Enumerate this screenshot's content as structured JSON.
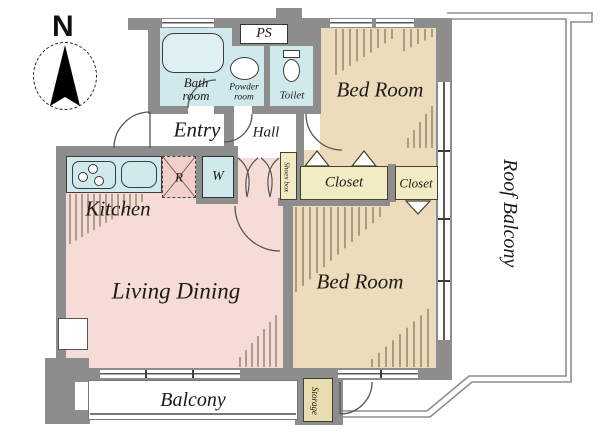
{
  "plan": {
    "north_label": "N",
    "rooms": {
      "entry": "Entry",
      "hall": "Hall",
      "bath": "Bath room",
      "powder": "Powder room",
      "toilet": "Toilet",
      "ps": "PS",
      "bedroom_top": "Bed Room",
      "bedroom_bottom": "Bed Room",
      "kitchen": "Kitchen",
      "living_dining": "Living Dining",
      "closet_left": "Closet",
      "closet_right": "Closet",
      "shoes_box": "Shoes box",
      "washing_machine": "W",
      "refrigerator": "R",
      "balcony": "Balcony",
      "roof_balcony": "Roof Balcony",
      "storage": "Storage"
    },
    "icons": {
      "north_arrow": "compass-needle",
      "bathtub": "bathtub-shape",
      "wash_basin": "oval-basin",
      "toilet_bowl": "toilet-shape",
      "stove": "three-burner-stove",
      "kitchen_sink": "rounded-sink"
    },
    "colors": {
      "wall": "#8d8d8d",
      "wet_rooms": "#cfe9ed",
      "bedrooms": "#ecdcbc",
      "living": "#f6dcd6",
      "closet": "#f1ecc3",
      "storage": "#e9dcae",
      "hatch": "#6b5c40",
      "line": "#555555"
    }
  }
}
